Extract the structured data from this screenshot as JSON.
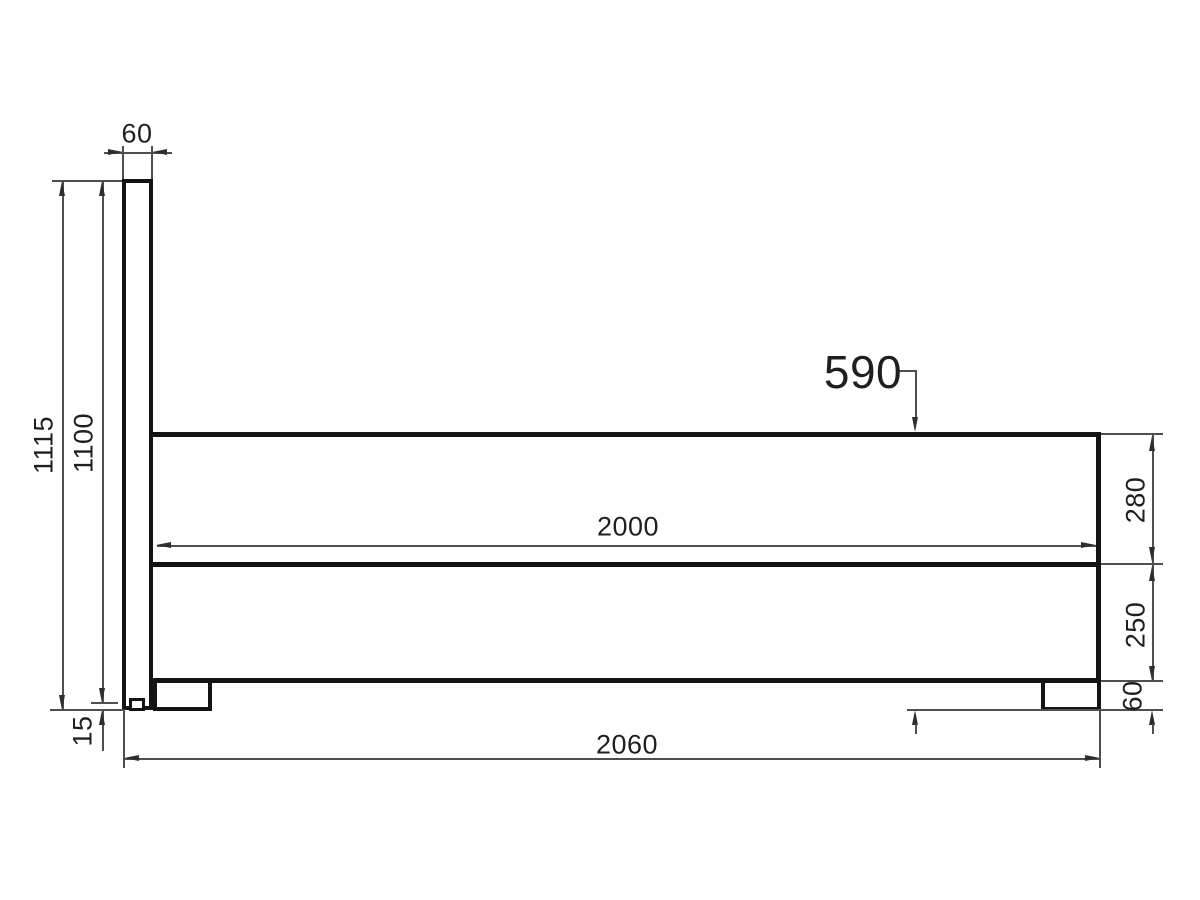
{
  "drawing": {
    "type": "technical-dimension-drawing",
    "subject": "bed frame side elevation",
    "background_color": "#ffffff",
    "outline_color": "#141414",
    "dimension_line_color": "#4f4f4f",
    "dimensions": {
      "headboard_width": "60",
      "overall_height": "1115",
      "headboard_panel_height": "1100",
      "glide_foot_height": "15",
      "platform_top_height": "590",
      "inner_mattress_length": "2000",
      "upper_section_depth": "280",
      "lower_section_depth": "250",
      "leg_height": "60",
      "overall_length": "2060"
    }
  }
}
